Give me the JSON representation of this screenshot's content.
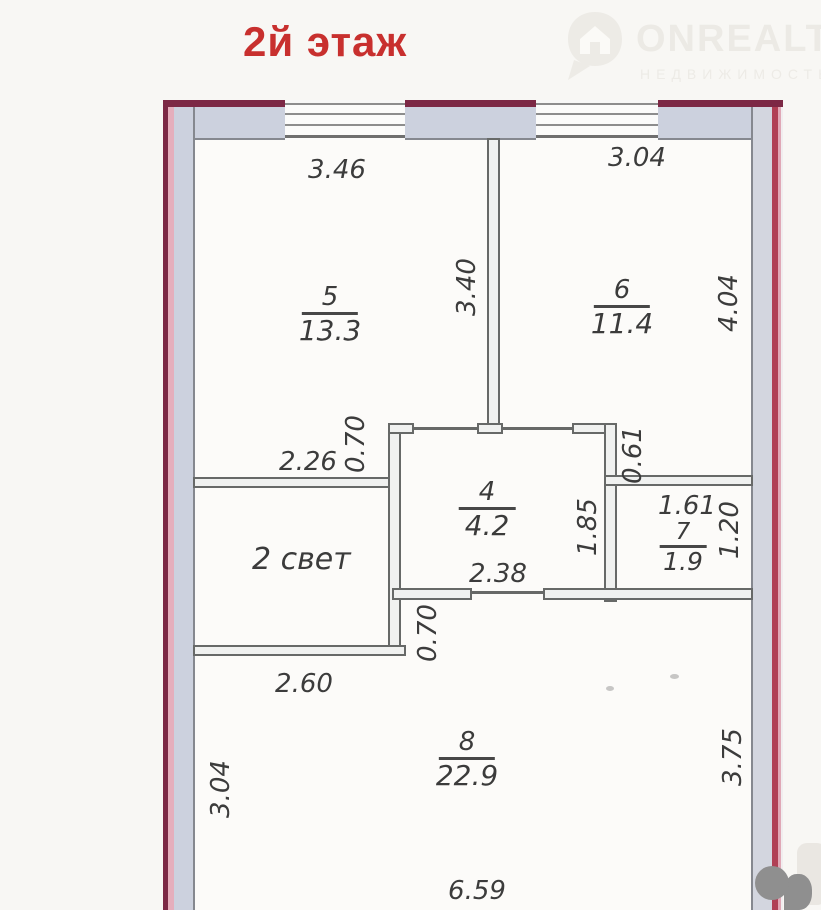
{
  "title": {
    "text": "2й этаж"
  },
  "watermark": {
    "brand": "ONREALT",
    "subtitle": "НЕДВИЖИМОСТЬ"
  },
  "plan": {
    "rooms": {
      "room5": {
        "number": "5",
        "area": "13.3"
      },
      "room6": {
        "number": "6",
        "area": "11.4"
      },
      "room4": {
        "number": "4",
        "area": "4.2"
      },
      "room7": {
        "number": "7",
        "area": "1.9"
      },
      "room8": {
        "number": "8",
        "area": "22.9"
      }
    },
    "light_well": "2 свет",
    "dims": {
      "room5_width": "3.46",
      "room6_width": "3.04",
      "room5_height": "3.40",
      "room6_height": "4.04",
      "step_upper": "0.70",
      "room5_bottom": "2.26",
      "passage_height": "0.61",
      "room4_width": "2.38",
      "room4_height": "1.85",
      "room7_width": "1.61",
      "room7_height": "1.20",
      "step_lower": "0.70",
      "light_well_width": "2.60",
      "room8_left_height": "3.04",
      "room8_right_height": "3.75",
      "room8_width": "6.59"
    },
    "colors": {
      "title_red": "#c8302e",
      "outer_wall_outline": "#7c2845",
      "outer_wall_fill": "#ccd1de",
      "inner_wall_line": "#676968",
      "dimension_text": "#3c3c3c"
    }
  }
}
